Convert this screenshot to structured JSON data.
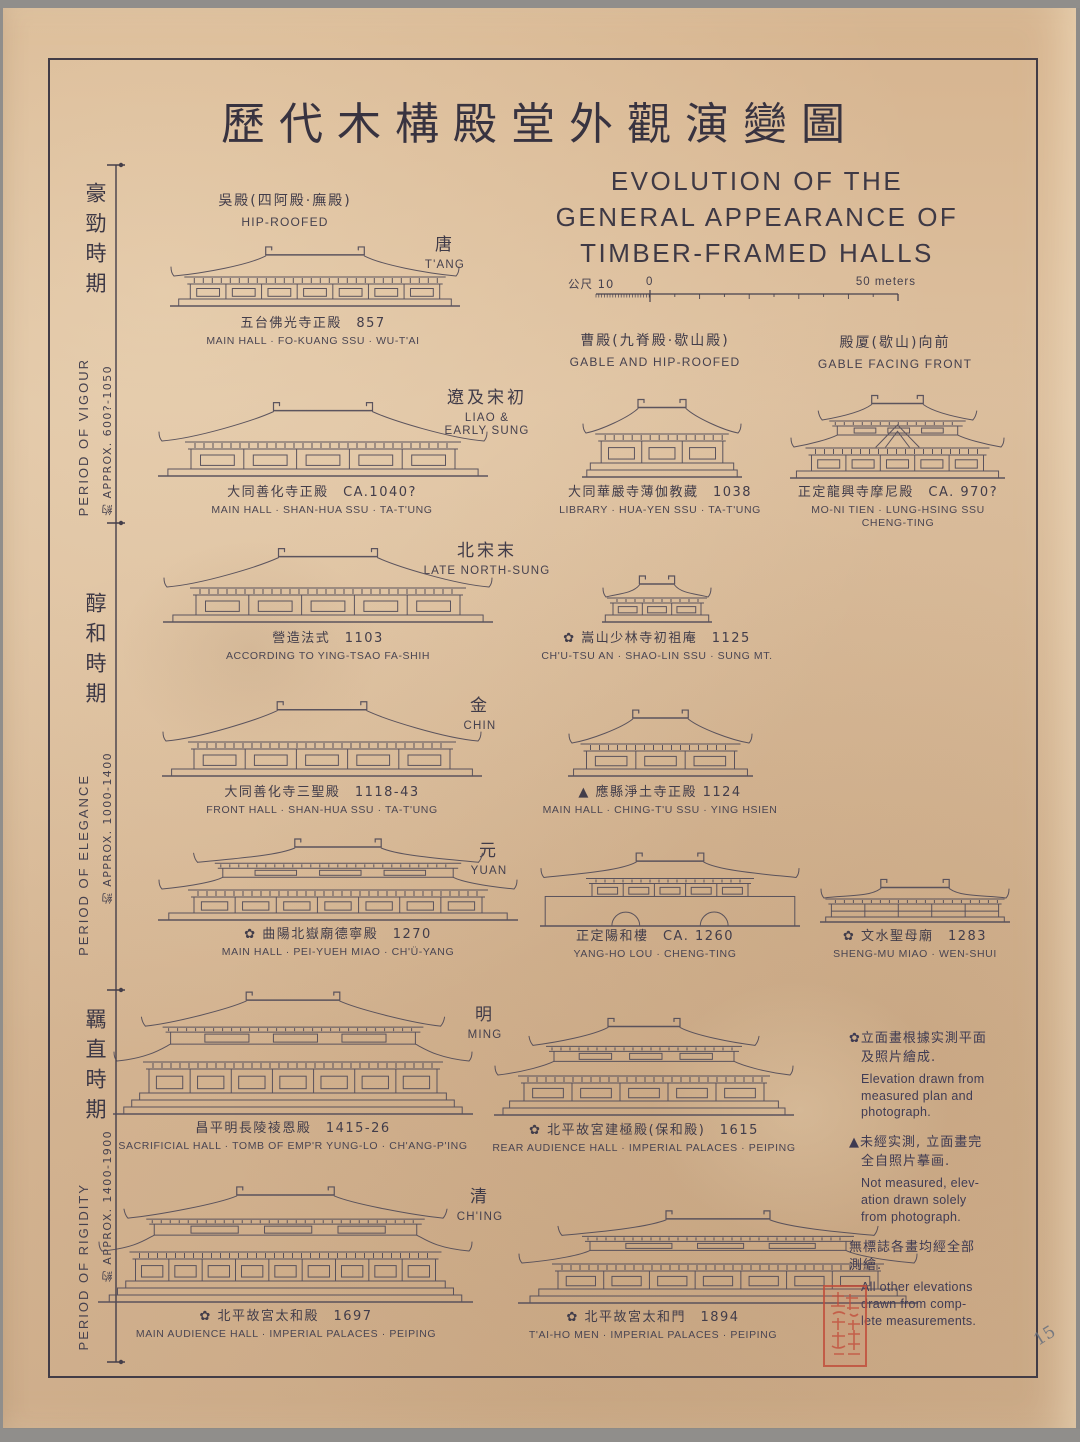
{
  "page": {
    "title_cn": "歷代木構殿堂外觀演變圖",
    "title_en": [
      "EVOLUTION OF THE",
      "GENERAL APPEARANCE OF",
      "TIMBER-FRAMED HALLS"
    ],
    "pencil_note": "15",
    "paper_color": "#d9ba98",
    "ink_color": "#46414e",
    "seal_color": "#c14a38"
  },
  "scalebar": {
    "left_label": "公尺 10",
    "zero_label": "0",
    "right_label": "50 meters"
  },
  "periods": [
    {
      "cn": "豪勁時期",
      "en": "PERIOD OF VIGOUR",
      "range": "約 APPROX. 600?-1050"
    },
    {
      "cn": "醇和時期",
      "en": "PERIOD OF ELEGANCE",
      "range": "約 APPROX. 1000-1400"
    },
    {
      "cn": "羈直時期",
      "en": "PERIOD OF RIGIDITY",
      "range": "約 APPROX. 1400-1900"
    }
  ],
  "roof_types": [
    {
      "cn": "吳殿(四阿殿·廡殿)",
      "en": "HIP-ROOFED"
    },
    {
      "cn": "曹殿(九脊殿·歇山殿)",
      "en": "GABLE AND HIP-ROOFED"
    },
    {
      "cn": "殿厦(歇山)向前",
      "en": "GABLE FACING FRONT"
    }
  ],
  "dynasties": [
    {
      "cn": "唐",
      "en1": "T'ANG",
      "en2": ""
    },
    {
      "cn": "遼及宋初",
      "en1": "LIAO &",
      "en2": "EARLY SUNG"
    },
    {
      "cn": "北宋末",
      "en1": "LATE NORTH-SUNG",
      "en2": ""
    },
    {
      "cn": "金",
      "en1": "CHIN",
      "en2": ""
    },
    {
      "cn": "元",
      "en1": "YUAN",
      "en2": ""
    },
    {
      "cn": "明",
      "en1": "MING",
      "en2": ""
    },
    {
      "cn": "清",
      "en1": "CH'ING",
      "en2": ""
    }
  ],
  "figures": {
    "fokuang": {
      "cn": "五台佛光寺正殿 857",
      "en": "MAIN HALL · FO-KUANG SSU · WU-T'AI"
    },
    "shanhua": {
      "cn": "大同善化寺正殿 CA.1040?",
      "en": "MAIN HALL · SHAN-HUA SSU · TA-T'UNG"
    },
    "huayen": {
      "cn": "大同華嚴寺薄伽教藏 1038",
      "en": "LIBRARY · HUA-YEN SSU · TA-T'UNG"
    },
    "moni": {
      "cn": "正定龍興寺摩尼殿 CA. 970?",
      "en": "MO-NI TIEN · LUNG-HSING SSU",
      "en2": "CHENG-TING"
    },
    "yingtsao": {
      "cn": "營造法式 1103",
      "en": "ACCORDING TO YING-TSAO FA-SHIH"
    },
    "chutsu": {
      "cn": "✿ 嵩山少林寺初祖庵 1125",
      "en": "CH'U-TSU AN · SHAO-LIN SSU · SUNG MT."
    },
    "sansheng": {
      "cn": "大同善化寺三聖殿 1118-43",
      "en": "FRONT HALL · SHAN-HUA SSU · TA-T'UNG"
    },
    "chingtu": {
      "cn": "▲ 應縣淨土寺正殿 1124",
      "en": "MAIN HALL · CHING-T'U SSU · YING HSIEN"
    },
    "peiyueh": {
      "cn": "✿ 曲陽北嶽廟德寧殿 1270",
      "en": "MAIN HALL · PEI-YUEH MIAO · CH'Ü-YANG"
    },
    "yangho": {
      "cn": "正定陽和樓 CA. 1260",
      "en": "YANG-HO LOU · CHENG-TING"
    },
    "shengmu": {
      "cn": "✿ 文水聖母廟 1283",
      "en": "SHENG-MU MIAO · WEN-SHUI"
    },
    "changling": {
      "cn": "昌平明長陵祾恩殿 1415-26",
      "en": "SACRIFICIAL HALL · TOMB OF EMP'R YUNG-LO · CH'ANG-P'ING"
    },
    "paoho": {
      "cn": "✿ 北平故宮建極殿(保和殿) 1615",
      "en": "REAR AUDIENCE HALL · IMPERIAL PALACES · PEIPING"
    },
    "taihodian": {
      "cn": "✿ 北平故宮太和殿 1697",
      "en": "MAIN AUDIENCE HALL · IMPERIAL PALACES · PEIPING"
    },
    "taihomen": {
      "cn": "✿ 北平故宮太和門 1894",
      "en": "T'AI-HO MEN · IMPERIAL PALACES · PEIPING"
    }
  },
  "legend": {
    "items": [
      {
        "mark": "✿",
        "cn1": "立面畫根據实測平面",
        "cn2": "及照片繪成.",
        "en1": "Elevation drawn from",
        "en2": "measured plan and",
        "en3": "photograph."
      },
      {
        "mark": "▲",
        "cn1": "未經实測, 立面畫完",
        "cn2": "全自照片摹画.",
        "en1": "Not measured, elev-",
        "en2": "ation drawn solely",
        "en3": "from photograph."
      },
      {
        "mark": "",
        "cn1": "無標誌各畫均經全部",
        "cn2": "測繪.",
        "en1": "All other elevations",
        "en2": "drawn from comp-",
        "en3": "lete measurements."
      }
    ]
  }
}
